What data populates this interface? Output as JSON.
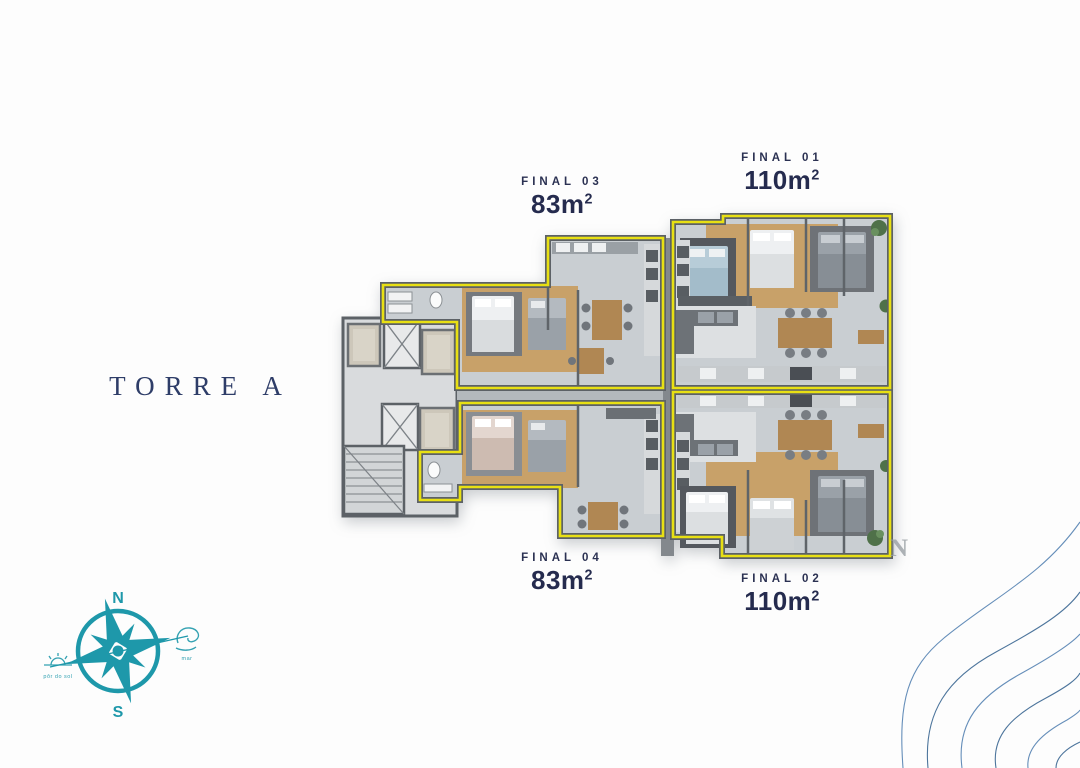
{
  "tower": {
    "label": "TORRE A"
  },
  "units": [
    {
      "id": "final-01",
      "label": "FINAL 01",
      "area_base": "110m",
      "area_sup": "2"
    },
    {
      "id": "final-02",
      "label": "FINAL 02",
      "area_base": "110m",
      "area_sup": "2"
    },
    {
      "id": "final-03",
      "label": "FINAL 03",
      "area_base": "83m",
      "area_sup": "2"
    },
    {
      "id": "final-04",
      "label": "FINAL 04",
      "area_base": "83m",
      "area_sup": "2"
    }
  ],
  "compass": {
    "north": "N",
    "south": "S",
    "sunset_label": "pôr do sol",
    "sea_label": "mar"
  },
  "watermark_letter": "N",
  "colors": {
    "label_navy": "#272e52",
    "tower_navy": "#2e3d68",
    "unit_outline_yellow": "#e8e013",
    "compass_teal": "#1e98aa",
    "wave_blue": "#4b7bae",
    "plan_floor": "#c9ced2",
    "plan_wood": "#c8a169",
    "plan_wall": "#5c6166"
  }
}
